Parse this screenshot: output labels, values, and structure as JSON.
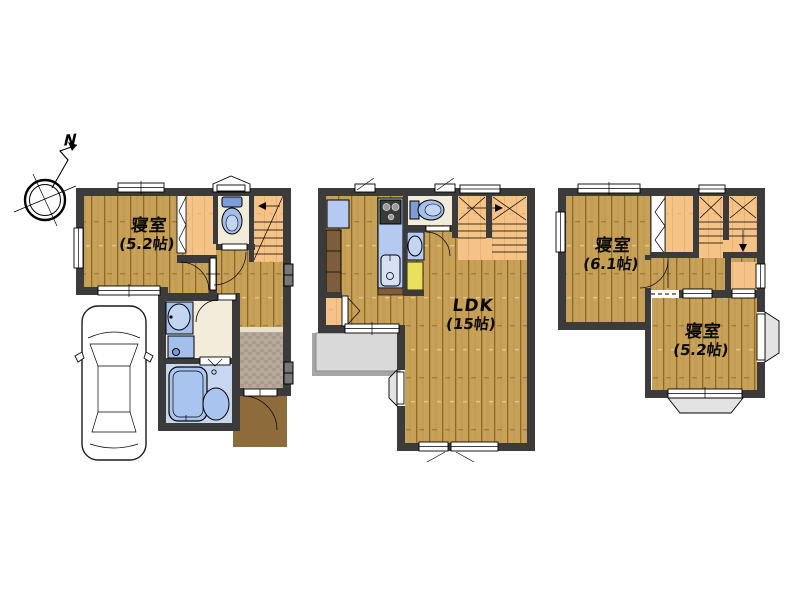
{
  "compass": {
    "label": "N"
  },
  "floors": {
    "floor1": {
      "bedroom": {
        "name": "寝室",
        "size": "(5.2帖)"
      }
    },
    "floor2": {
      "ldk": {
        "name": "LDK",
        "size": "(15帖)"
      }
    },
    "floor3": {
      "bedroom1": {
        "name": "寝室",
        "size": "(6.1帖)"
      },
      "bedroom2": {
        "name": "寝室",
        "size": "(5.2帖)"
      }
    }
  },
  "palette": {
    "wall": "#3B3B3B",
    "wood_floor": "#C8A159",
    "stairs_closet_orange": "#F5C287",
    "toilet_washroom_cream": "#F3ECDA",
    "fixture_blue": "#A3BFEC",
    "kitchen_counter_blue": "#B5CAF1",
    "bathroom_floor_blue": "#C9D6F0",
    "entrance_tile_gray": "#B1A494",
    "porch_brown": "#8E6B3B",
    "cabinet_brown": "#7D5E3C",
    "storage_yellow": "#E9E15E",
    "balcony_gray": "#D9D9D9"
  }
}
